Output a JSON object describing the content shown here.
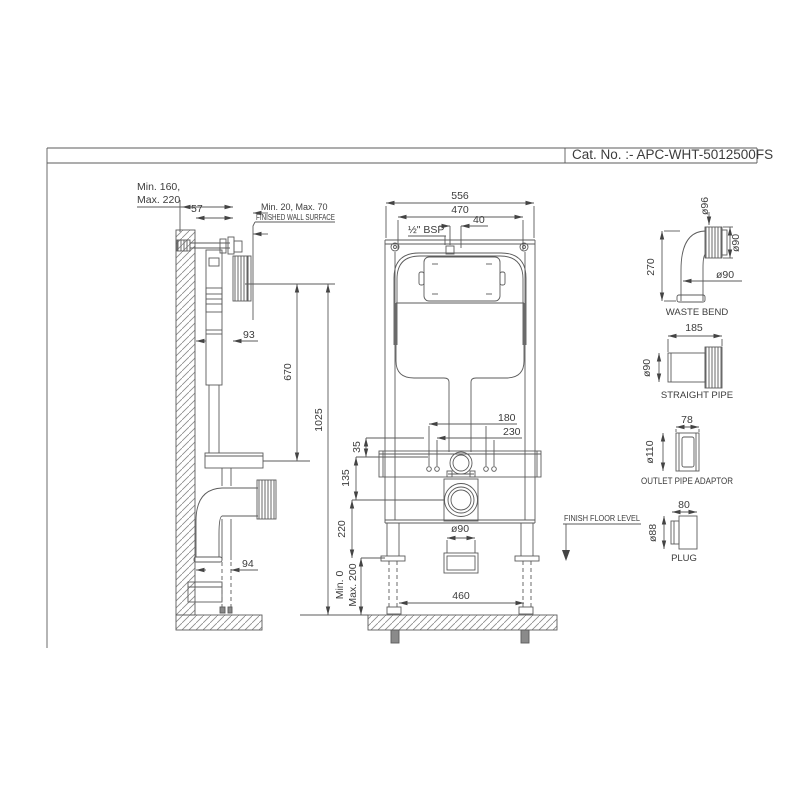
{
  "title_block": {
    "cat_no": "Cat. No. :- APC-WHT-5012500FS"
  },
  "side_view": {
    "depth_min": "Min. 160,",
    "depth_max": "Max. 220",
    "dim_57": "57",
    "finish_min_max": "Min. 20, Max. 70",
    "finished_wall_surface": "FINISHED WALL SURFACE",
    "dim_93": "93",
    "dim_670": "670",
    "dim_1025": "1025",
    "dim_94": "94"
  },
  "front_view": {
    "dim_556": "556",
    "dim_470": "470",
    "dim_40": "40",
    "inlet_label": "½\" BSP",
    "dim_180": "180",
    "dim_230": "230",
    "dim_35": "35",
    "dim_135": "135",
    "dim_220": "220",
    "leg_min": "Min. 0",
    "leg_max": "Max. 200",
    "outlet_dia": "ø90",
    "dim_460": "460",
    "floor_label": "FINISH FLOOR LEVEL"
  },
  "parts": {
    "waste_bend": {
      "name": "WASTE BEND",
      "dia_inlet": "ø96",
      "dia_collar": "ø90",
      "dia_pipe": "ø90",
      "dim_height": "270"
    },
    "straight_pipe": {
      "name": "STRAIGHT PIPE",
      "dim_length": "185",
      "dia": "ø90"
    },
    "outlet_adaptor": {
      "name": "OUTLET PIPE ADAPTOR",
      "dim_length": "78",
      "dia": "ø110"
    },
    "plug": {
      "name": "PLUG",
      "dim_length": "80",
      "dia": "ø88"
    }
  },
  "colors": {
    "line": "#5b5b5b",
    "text": "#3c3c3c",
    "background": "#ffffff"
  }
}
